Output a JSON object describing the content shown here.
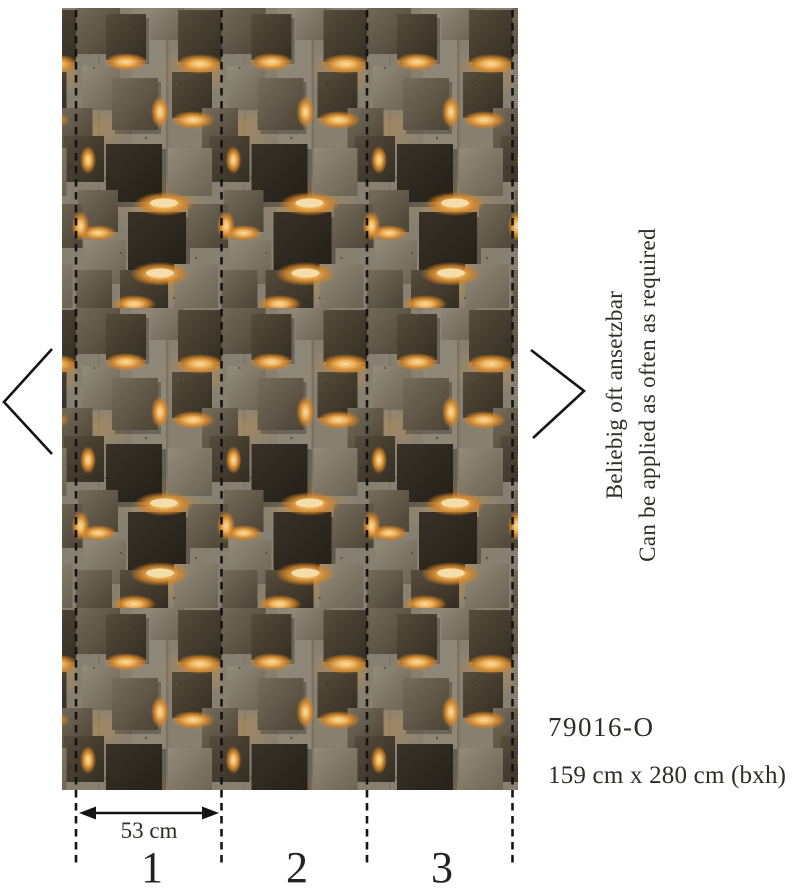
{
  "product": {
    "code": "79016-O",
    "dimensions": "159 cm x 280 cm (bxh)",
    "panel_width_label": "53 cm",
    "panel_numbers": [
      "1",
      "2",
      "3"
    ],
    "repeat_note_de": "Beliebig oft ansetzbar",
    "repeat_note_en": "Can be applied as often as required"
  },
  "icons": {
    "chevron_left": "chevron pointing left of pattern",
    "chevron_right": "chevron pointing right of pattern"
  },
  "palette": {
    "annotation_ink": "#141414",
    "text_ink": "#2e2c29",
    "concrete": "#8d8577",
    "bronze_dark": "#352e24",
    "bronze_light": "#9a9180",
    "glow": "#fbbd62"
  }
}
